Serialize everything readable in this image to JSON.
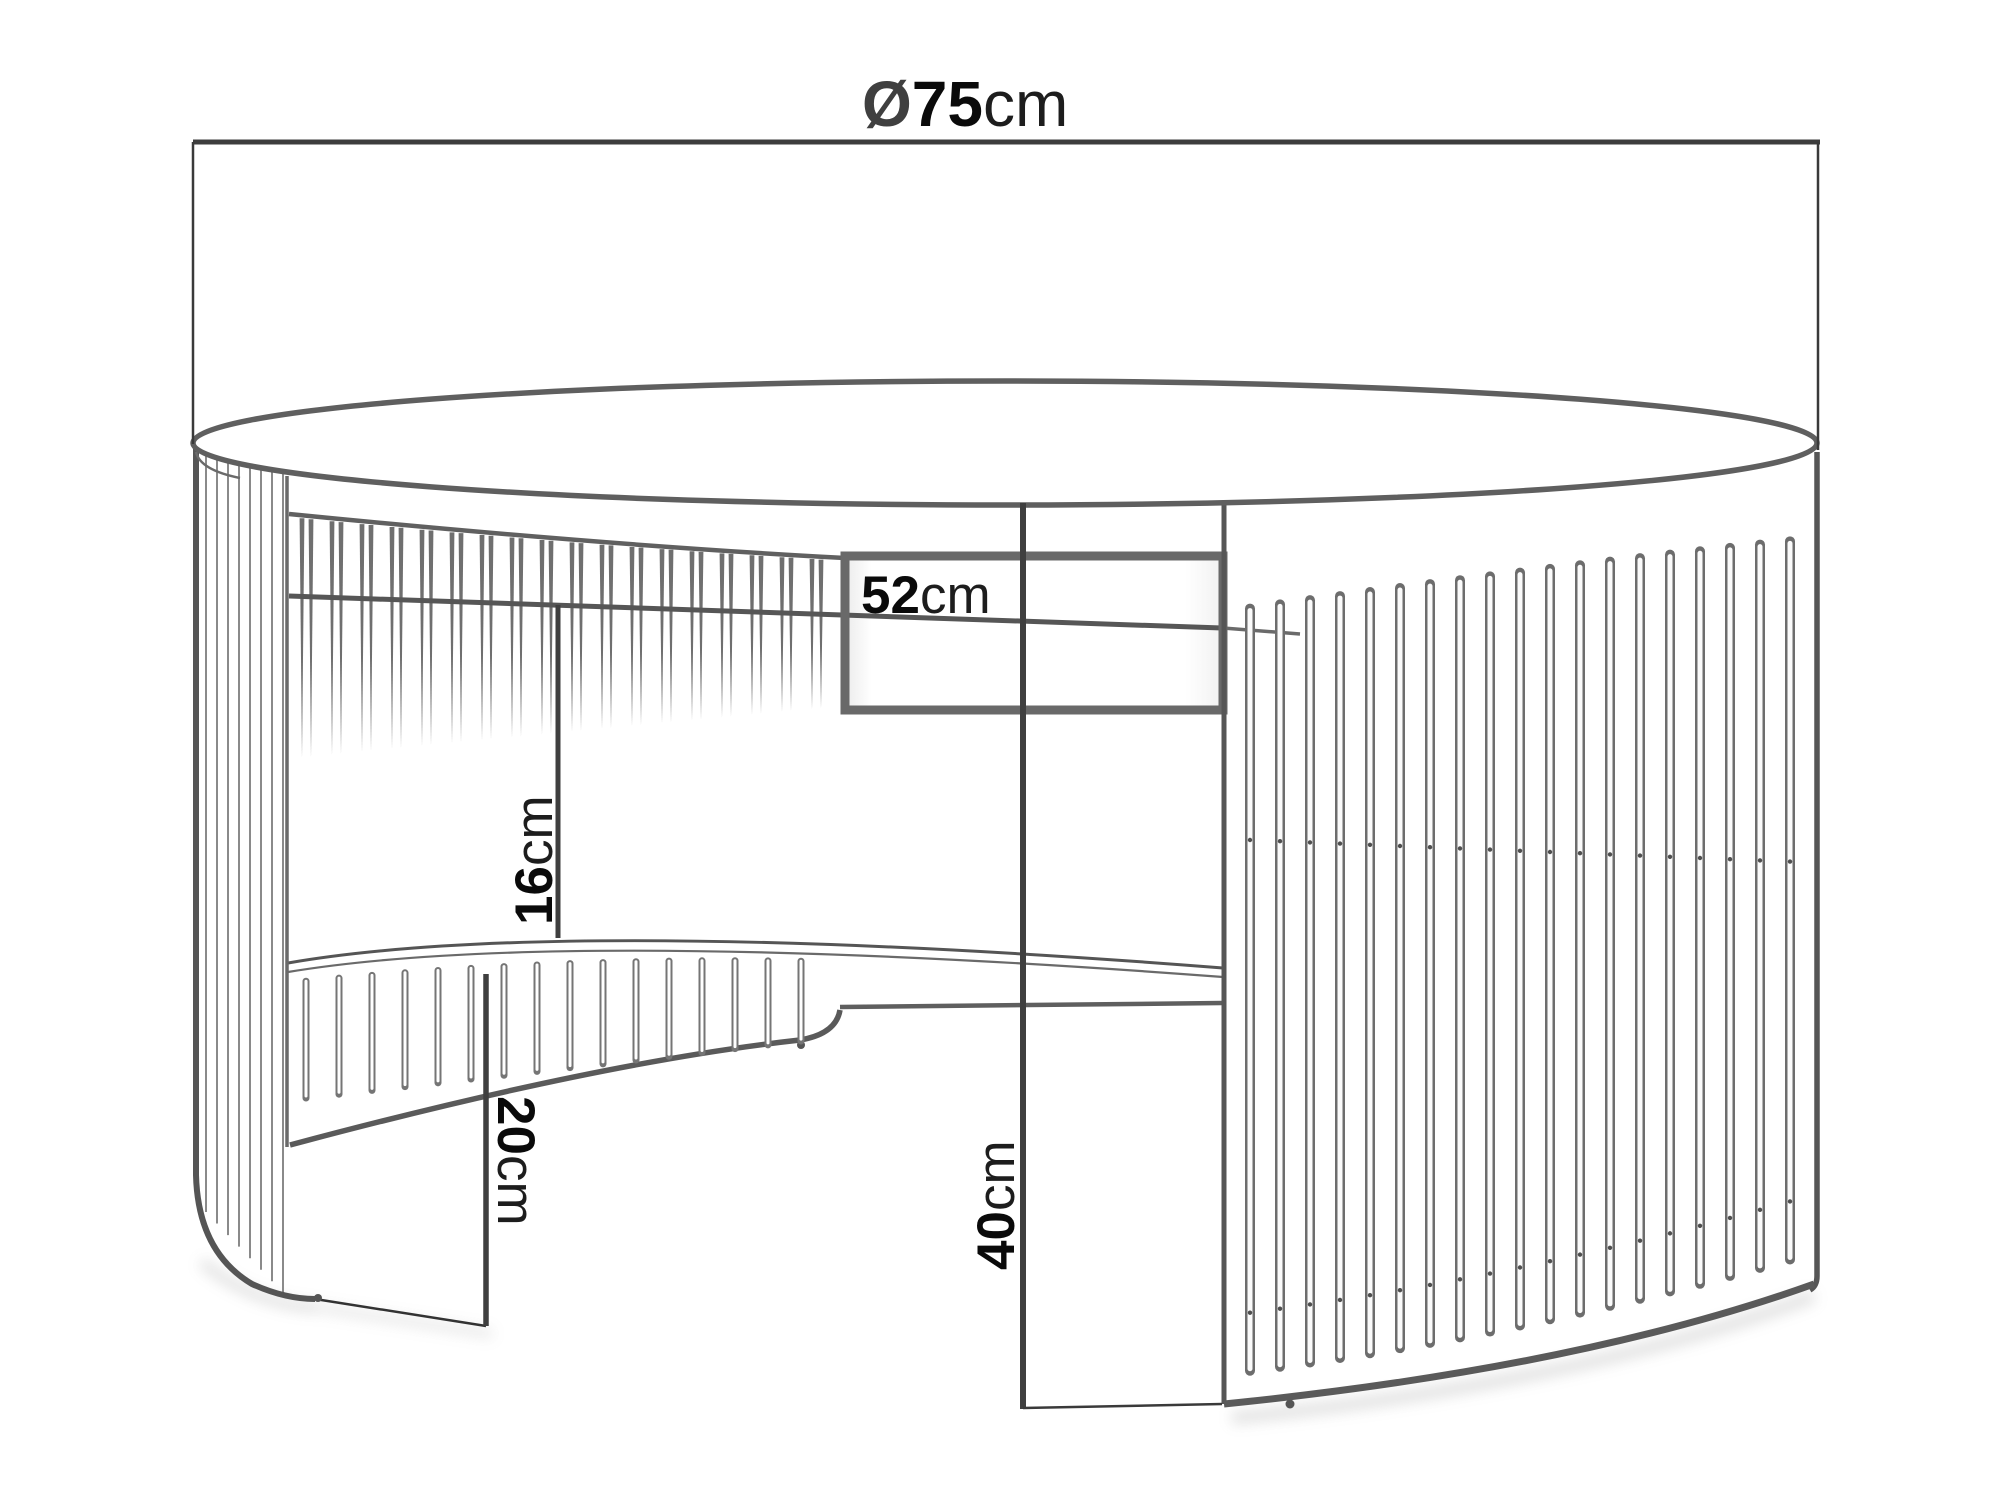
{
  "drawing": {
    "background_color": "#ffffff",
    "structure_line_color": "#5a5a5a",
    "slat_color": "#6f6f6f",
    "dimension_line_color": "#3d3d3d",
    "label_color": "#0a0a0a"
  },
  "dimensions": {
    "diameter": {
      "symbol": "Ø",
      "value": "75",
      "unit": "cm"
    },
    "opening_width": {
      "value": "52",
      "unit": "cm"
    },
    "shelf_clearance": {
      "value": "16",
      "unit": "cm"
    },
    "lower_height": {
      "value": "20",
      "unit": "cm"
    },
    "total_height": {
      "value": "40",
      "unit": "cm"
    }
  }
}
